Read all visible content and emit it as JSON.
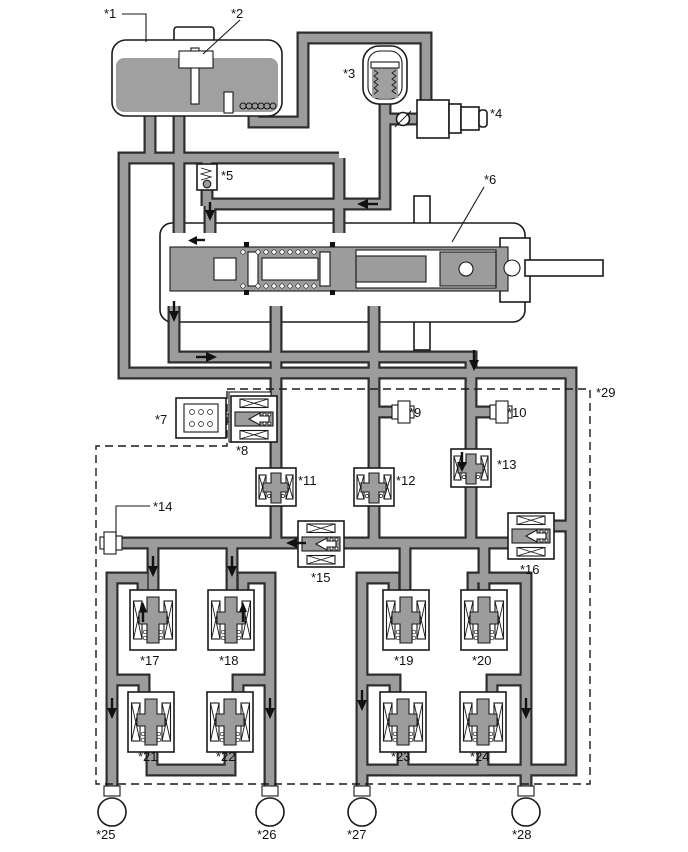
{
  "figure": {
    "labels": {
      "l1": "*1",
      "l2": "*2",
      "l3": "*3",
      "l4": "*4",
      "l5": "*5",
      "l6": "*6",
      "l7": "*7",
      "l8": "*8",
      "l9": "*9",
      "l10": "*10",
      "l11": "*11",
      "l12": "*12",
      "l13": "*13",
      "l14": "*14",
      "l15": "*15",
      "l16": "*16",
      "l17": "*17",
      "l18": "*18",
      "l19": "*19",
      "l20": "*20",
      "l21": "*21",
      "l22": "*22",
      "l23": "*23",
      "l24": "*24",
      "l25": "*25",
      "l26": "*26",
      "l27": "*27",
      "l28": "*28",
      "l29": "*29"
    },
    "colors": {
      "pipe_fill": "#9c9c9c",
      "pipe_outline": "#2e2e2e",
      "component_fill": "#ffffff",
      "line": "#1a1a1a",
      "reservoir_fluid": "#a0a0a0",
      "background": "#ffffff"
    }
  }
}
